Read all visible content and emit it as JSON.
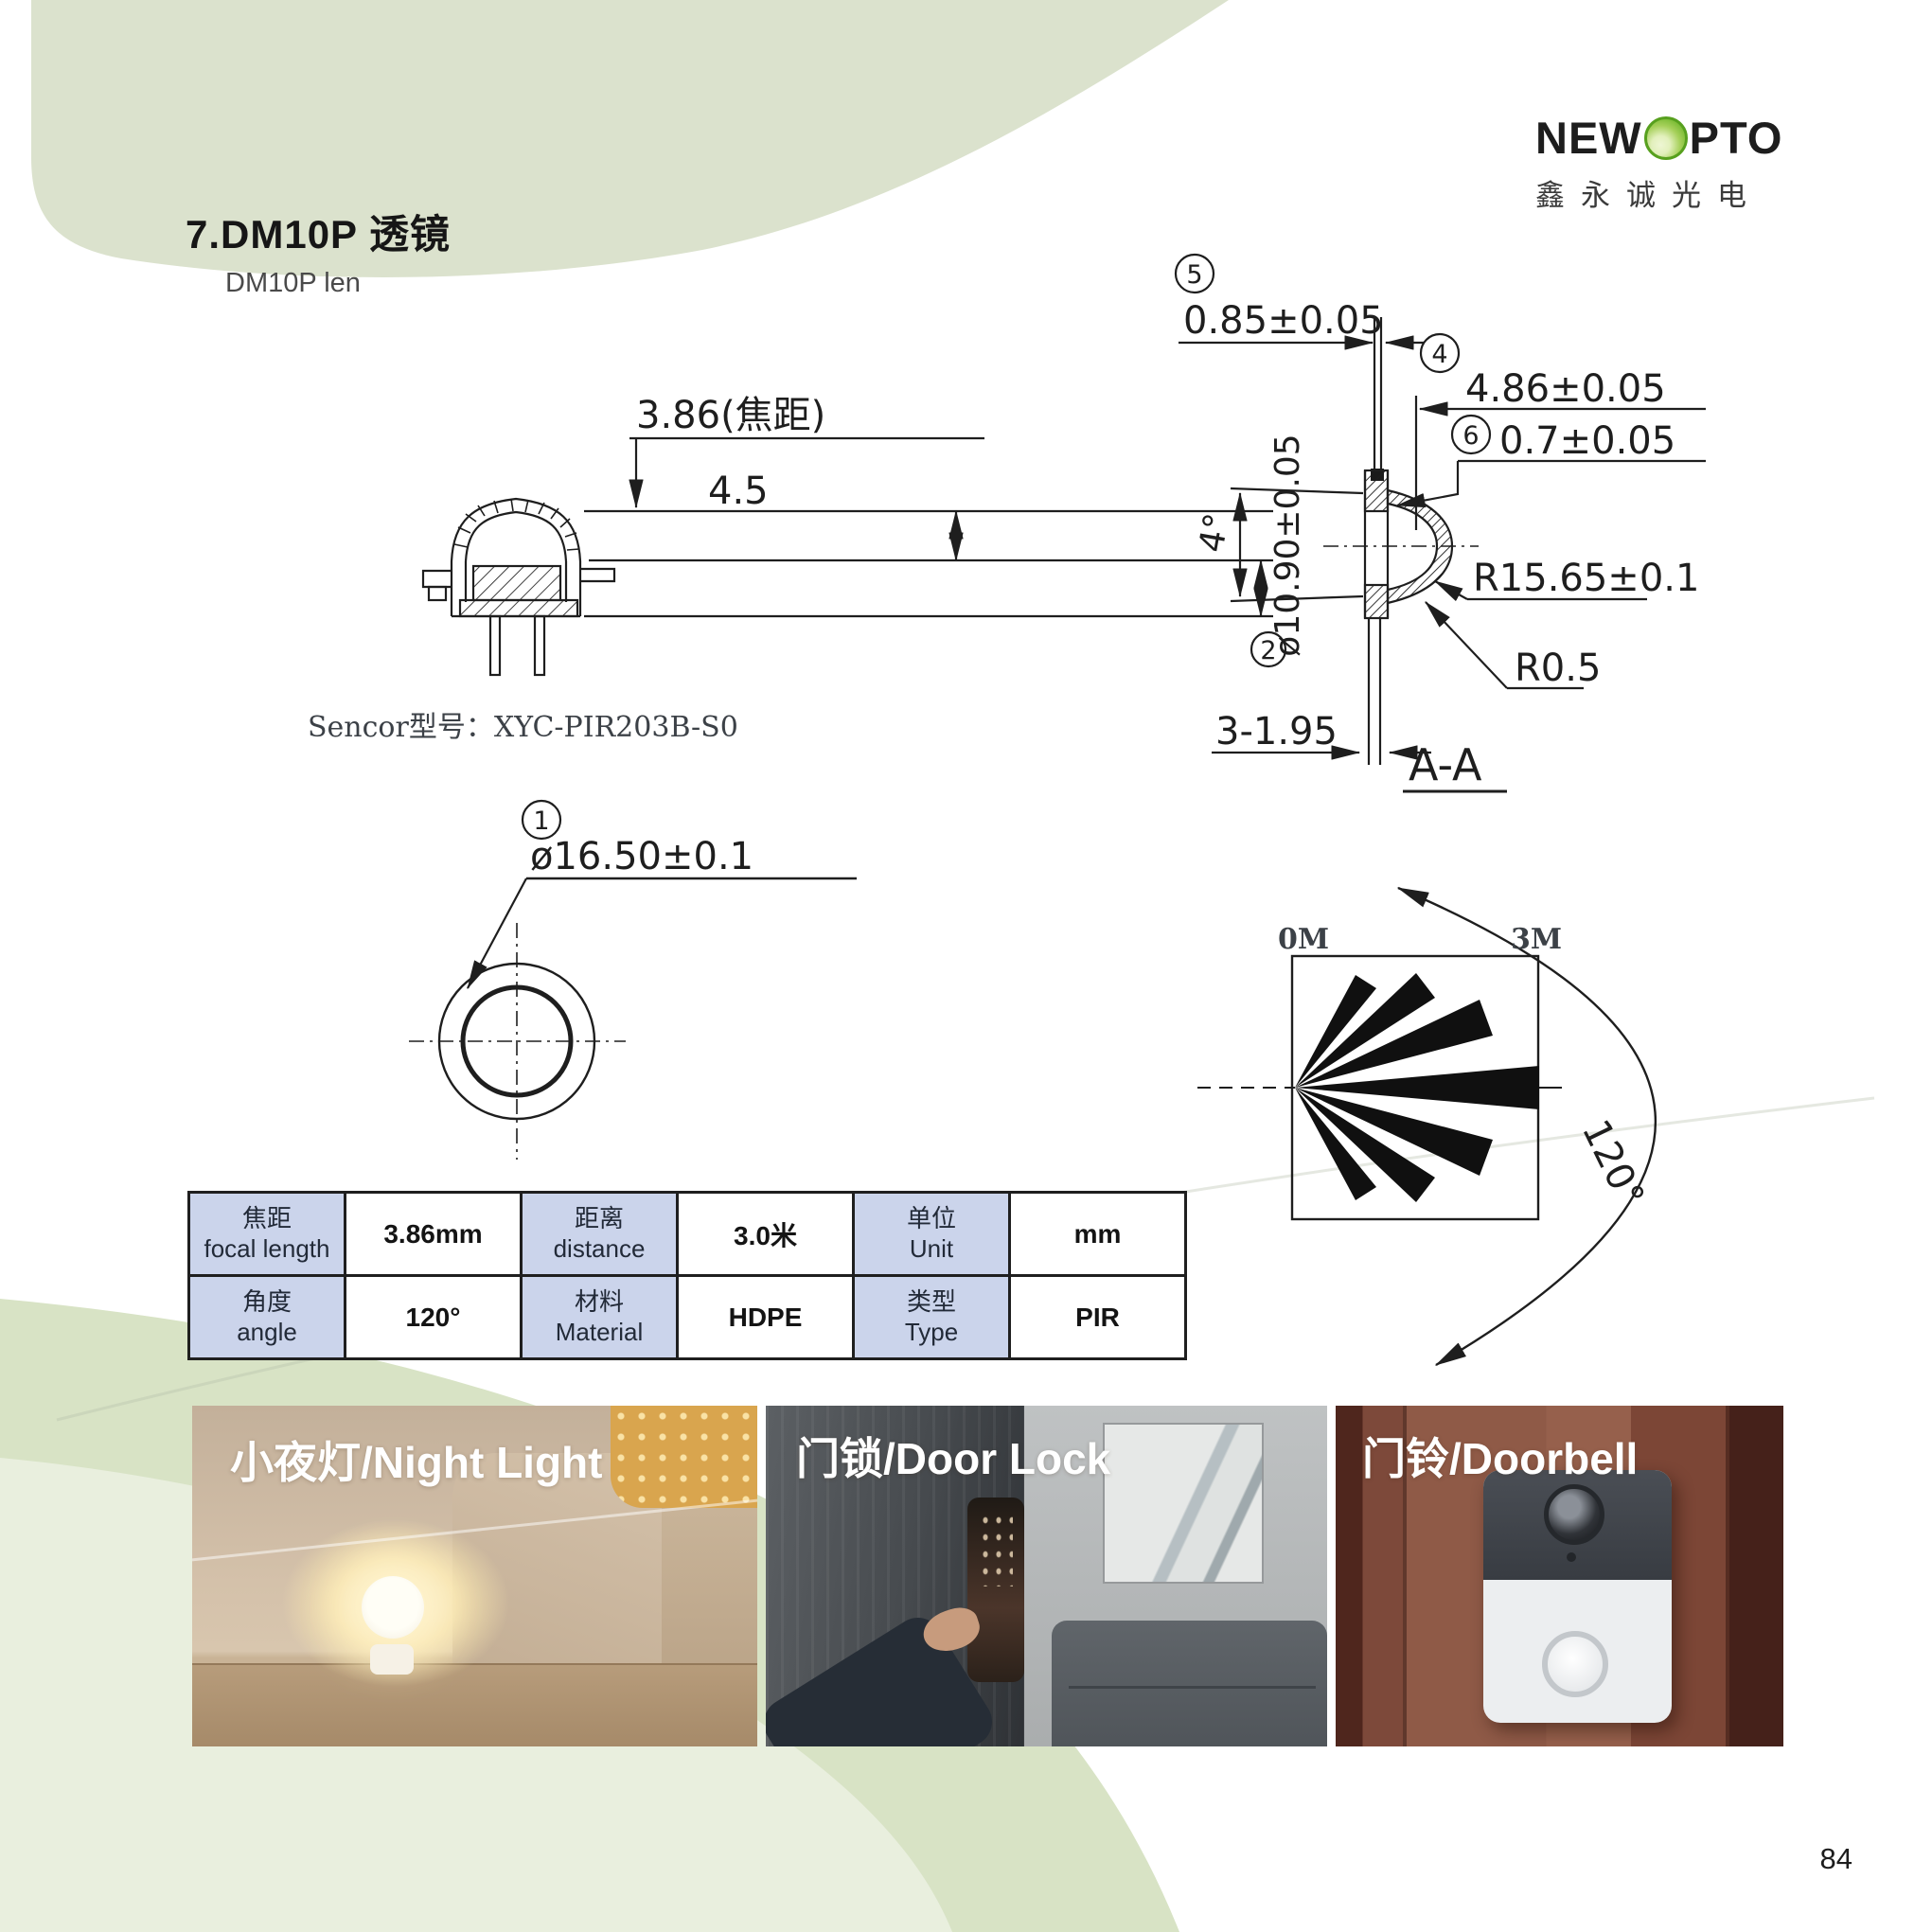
{
  "page": {
    "number": "84"
  },
  "header": {
    "title": "7.DM10P 透镜",
    "subtitle": "DM10P len"
  },
  "logo": {
    "brand_left": "NEW",
    "brand_right": "PTO",
    "subtitle": "鑫永诚光电",
    "accent_green": "#74b92f"
  },
  "colors": {
    "top_blob_green": "#dbe2cd",
    "wave_green_dark": "#d8e3c5",
    "wave_green_light": "#e9efde",
    "table_header_blue": "#cbd4eb"
  },
  "drawings": {
    "side": {
      "dim_focal": "3.86(焦距)",
      "dim_height": "4.5",
      "sensor_label": "Sencor型号：XYC-PIR203B-S0"
    },
    "top": {
      "balloon1": "1",
      "dim_diameter": "ø16.50±0.1"
    },
    "aa": {
      "balloon5": "5",
      "dim5": "0.85±0.05",
      "balloon4": "4",
      "dim4": "4.86±0.05",
      "balloon6": "6",
      "dim6": "0.7±0.05",
      "dim_angle": "4°",
      "balloon2": "2",
      "dim_diameter": "ø10.90±0.05",
      "dim_radius_outer": "R15.65±0.1",
      "dim_radius_edge": "R0.5",
      "dim_pins": "3-1.95",
      "view_label": "A-A"
    },
    "beam": {
      "label_left": "0M",
      "label_right": "3M",
      "angle_label": "120°"
    }
  },
  "spec_table": {
    "r1c1_zh": "焦距",
    "r1c1_en": "focal length",
    "r1v1": "3.86mm",
    "r1c2_zh": "距离",
    "r1c2_en": "distance",
    "r1v2": "3.0米",
    "r1c3_zh": "单位",
    "r1c3_en": "Unit",
    "r1v3": "mm",
    "r2c1_zh": "角度",
    "r2c1_en": "angle",
    "r2v1": "120°",
    "r2c2_zh": "材料",
    "r2c2_en": "Material",
    "r2v2": "HDPE",
    "r2c3_zh": "类型",
    "r2c3_en": "Type",
    "r2v3": "PIR"
  },
  "photos": {
    "night_light": {
      "caption": "小夜灯/Night Light"
    },
    "door_lock": {
      "caption": "门锁/Door Lock"
    },
    "doorbell": {
      "caption": "门铃/Doorbell"
    }
  }
}
